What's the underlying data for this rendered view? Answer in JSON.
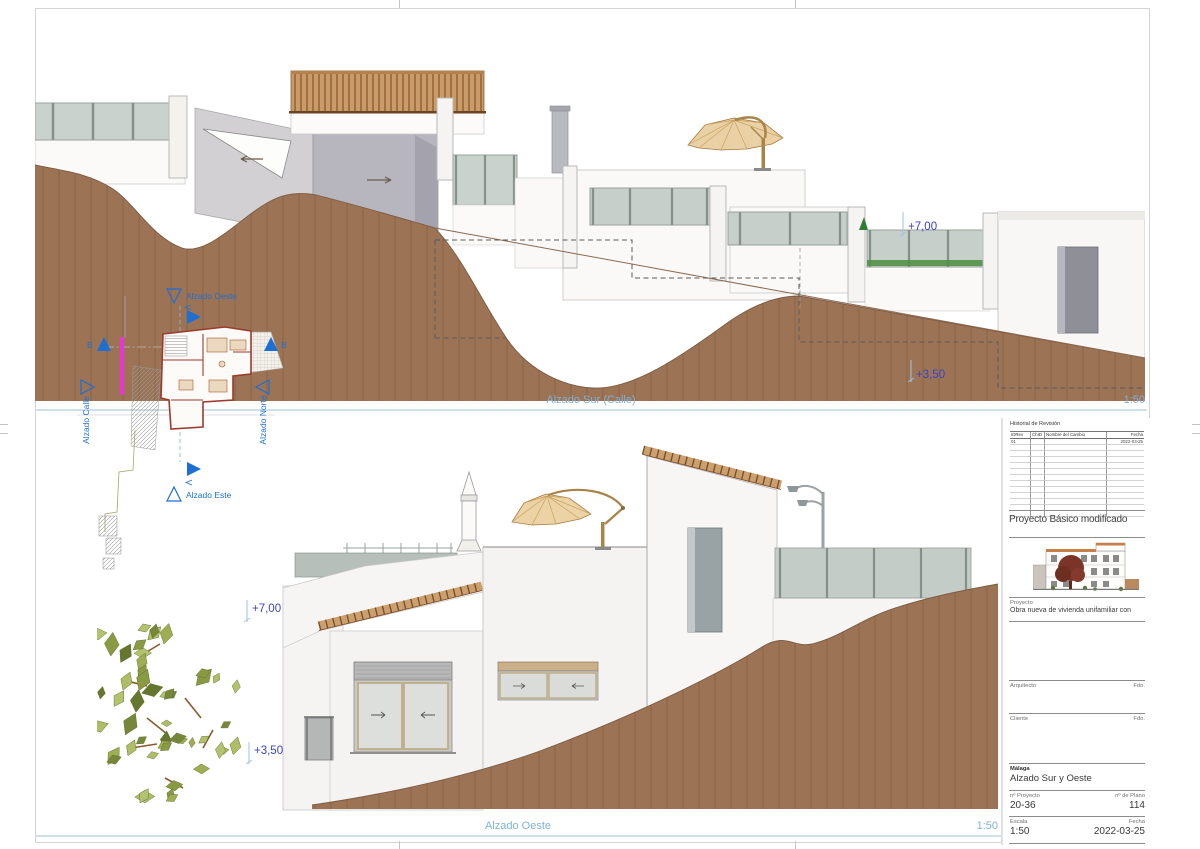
{
  "colors": {
    "label-blue": "#7fb2d9",
    "marker-blue": "#1e6fd2",
    "level-blue": "#3b43c6",
    "terrain": "#9c7355",
    "magenta": "#e935d8"
  },
  "drawings": {
    "south": {
      "title": "Alzado Sur (Calle)",
      "scale": "1:50",
      "levels": {
        "upper": "+7,00",
        "lower": "+3,50"
      }
    },
    "west": {
      "title": "Alzado Oeste",
      "scale": "1:50",
      "levels": {
        "upper": "+7,00",
        "lower": "+3,50"
      }
    }
  },
  "site_key": {
    "west": "Alzado Oeste",
    "east": "Alzado Este",
    "street": "Alzado Calle",
    "north": "Alzado Norte",
    "section_b_left": "B",
    "section_b_right": "B"
  },
  "title_block": {
    "revision_history": {
      "title": "Historial de Revisión",
      "columns": [
        "IDRev",
        "ChID",
        "Nombre del Cambio",
        "Fecha"
      ],
      "rows": [
        {
          "idrev": "01",
          "chid": "",
          "nombre": "",
          "fecha": "2022-03-25"
        }
      ],
      "empty_rows": 12
    },
    "project_title": "Proyecto Básico modificado",
    "project_label": "Proyecto",
    "project_description": "Obra nueva de vivienda unifamiliar con",
    "architect_label": "Arquitecto",
    "architect_sign_label": "Fdo.",
    "client_label": "Cliente",
    "client_sign_label": "Fdo.",
    "location": "Málaga",
    "sheet_title": "Alzado Sur y Oeste",
    "project_number_label": "nº Proyecto",
    "project_number": "20-36",
    "plan_number_label": "nº de Plano",
    "plan_number": "114",
    "scale_label": "Escala",
    "scale_value": "1:50",
    "date_label": "Fecha",
    "date_value": "2022-03-25"
  }
}
